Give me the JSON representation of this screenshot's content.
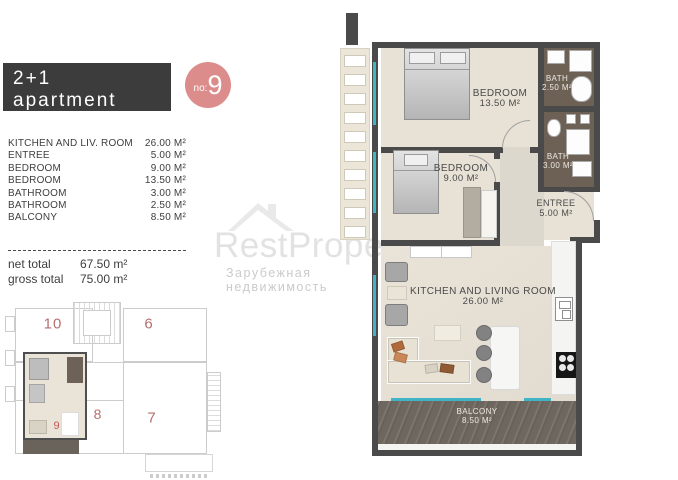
{
  "header": {
    "title": "2+1 apartment",
    "subtitle": "first floor",
    "badge": {
      "prefix": "no:",
      "number": "9"
    }
  },
  "room_list": [
    {
      "label": "KITCHEN AND LIV. ROOM",
      "value": "26.00 M²"
    },
    {
      "label": "ENTREE",
      "value": "5.00 M²"
    },
    {
      "label": "BEDROOM",
      "value": "9.00 M²"
    },
    {
      "label": "BEDROOM",
      "value": "13.50 M²"
    },
    {
      "label": "BATHROOM",
      "value": "3.00 M²"
    },
    {
      "label": "BATHROOM",
      "value": "2.50 M²"
    },
    {
      "label": "BALCONY",
      "value": "8.50 M²"
    }
  ],
  "totals": [
    {
      "label": "net total",
      "value": "67.50 m²"
    },
    {
      "label": "gross total",
      "value": "75.00 m²"
    }
  ],
  "watermark": {
    "brand": "RestProperty",
    "tagline": "Зарубежная недвижимость",
    "logo": "house-roof-icon"
  },
  "floor_plan": {
    "rooms": {
      "bedroom_large": {
        "name": "BEDROOM",
        "area": "13.50 M²"
      },
      "bath_small": {
        "name": "BATH",
        "area": "2.50 M²"
      },
      "bedroom_small": {
        "name": "BEDROOM",
        "area": "9.00 M²"
      },
      "bath_large": {
        "name": "BATH",
        "area": "3.00 M²"
      },
      "entree": {
        "name": "ENTREE",
        "area": "5.00 M²"
      },
      "living": {
        "name": "KITCHEN AND LIVING ROOM",
        "area": "26.00 M²"
      },
      "balcony": {
        "name": "BALCONY",
        "area": "8.50 M²"
      }
    }
  },
  "mini_plan": {
    "units": [
      {
        "number": "10"
      },
      {
        "number": "6"
      },
      {
        "number": "8"
      },
      {
        "number": "7"
      }
    ],
    "highlighted": "9"
  },
  "colors": {
    "accent_pink": "#DD8C8C",
    "walls": "#4A4A4A",
    "window_teal": "#3FB4C6",
    "bath_floor": "#6D6156",
    "balcony_floor": "#6E675F",
    "room_floor": "#E7E1D6",
    "unit_number_red": "#B4706D"
  }
}
